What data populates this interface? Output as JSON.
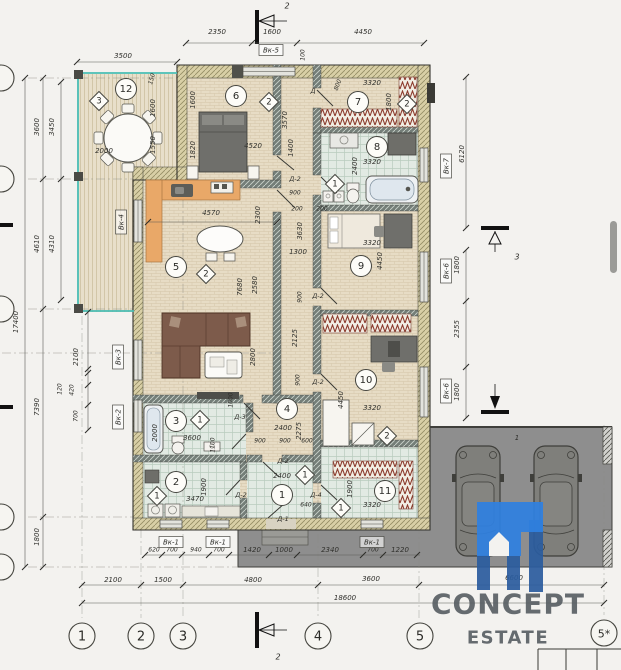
{
  "logo": {
    "line1": "CONCEPT",
    "line2": "ESTATE"
  },
  "colors": {
    "background": "#F3F2EF",
    "accent_teal": "#49BDB3",
    "wall_hatch": "#747E78",
    "wall_insulation": "#D8CFA6",
    "floor_wood": "#E7DCC5",
    "floor_tile": "#E2EAE3",
    "kitchen_counter": "#E9A868",
    "sofa_brown": "#7D5B4B",
    "radiator_red": "#8C3A2C",
    "garage_grey": "#8E8E8E",
    "logo_blue": "#2F80E0",
    "logo_blue_dark": "#2B5D9E",
    "logo_text": "#5A6065",
    "ink": "#30302C"
  },
  "grid_bubbles": [
    {
      "label": "1",
      "x": 82,
      "y": 636
    },
    {
      "label": "2",
      "x": 141,
      "y": 636
    },
    {
      "label": "3",
      "x": 183,
      "y": 636
    },
    {
      "label": "4",
      "x": 318,
      "y": 636
    },
    {
      "label": "5",
      "x": 420,
      "y": 636
    },
    {
      "label": "5*",
      "x": 604,
      "y": 633
    }
  ],
  "left_grid_bubbles": [
    {
      "y": 78
    },
    {
      "y": 179
    },
    {
      "y": 309
    },
    {
      "y": 517
    },
    {
      "y": 567
    }
  ],
  "rooms": [
    {
      "n": "12",
      "x": 126,
      "y": 89
    },
    {
      "n": "6",
      "x": 236,
      "y": 96
    },
    {
      "n": "7",
      "x": 358,
      "y": 102
    },
    {
      "n": "8",
      "x": 377,
      "y": 147
    },
    {
      "n": "5",
      "x": 176,
      "y": 267
    },
    {
      "n": "9",
      "x": 361,
      "y": 266
    },
    {
      "n": "10",
      "x": 366,
      "y": 380
    },
    {
      "n": "4",
      "x": 287,
      "y": 409
    },
    {
      "n": "3",
      "x": 176,
      "y": 421
    },
    {
      "n": "2",
      "x": 176,
      "y": 482
    },
    {
      "n": "1",
      "x": 282,
      "y": 495
    },
    {
      "n": "11",
      "x": 385,
      "y": 491
    }
  ],
  "diamonds": [
    {
      "n": "3",
      "x": 99,
      "y": 101
    },
    {
      "n": "2",
      "x": 269,
      "y": 102
    },
    {
      "n": "2",
      "x": 407,
      "y": 104
    },
    {
      "n": "1",
      "x": 335,
      "y": 184
    },
    {
      "n": "2",
      "x": 206,
      "y": 274
    },
    {
      "n": "1",
      "x": 305,
      "y": 475
    },
    {
      "n": "2",
      "x": 387,
      "y": 436
    },
    {
      "n": "1",
      "x": 200,
      "y": 420
    },
    {
      "n": "1",
      "x": 157,
      "y": 496
    },
    {
      "n": "1",
      "x": 341,
      "y": 508
    }
  ],
  "boxed_labels": [
    {
      "t": "Вк-5",
      "x": 271,
      "y": 50
    },
    {
      "t": "Вк-4",
      "x": 121,
      "y": 222,
      "rot": -90
    },
    {
      "t": "Вк-3",
      "x": 118,
      "y": 357,
      "rot": -90
    },
    {
      "t": "Вк-2",
      "x": 118,
      "y": 417,
      "rot": -90
    },
    {
      "t": "Вк-7",
      "x": 446,
      "y": 166,
      "rot": -90
    },
    {
      "t": "Вк-6",
      "x": 446,
      "y": 271,
      "rot": -90
    },
    {
      "t": "Вк-6",
      "x": 446,
      "y": 391,
      "rot": -90
    },
    {
      "t": "Вк-1",
      "x": 171,
      "y": 542
    },
    {
      "t": "Вк-1",
      "x": 218,
      "y": 542
    },
    {
      "t": "Вк-1",
      "x": 372,
      "y": 542
    }
  ],
  "annotations": [
    {
      "t": "3500",
      "x": 123,
      "y": 56
    },
    {
      "t": "2350",
      "x": 217,
      "y": 32
    },
    {
      "t": "1600",
      "x": 272,
      "y": 32
    },
    {
      "t": "4450",
      "x": 363,
      "y": 32
    },
    {
      "t": "100",
      "x": 303,
      "y": 55,
      "rot": -90,
      "fs": 6
    },
    {
      "t": "2",
      "x": 287,
      "y": 6,
      "fs": 8
    },
    {
      "t": "2",
      "x": 278,
      "y": 657,
      "fs": 8
    },
    {
      "t": "3",
      "x": 517,
      "y": 257,
      "fs": 8
    },
    {
      "t": "3600",
      "x": 37,
      "y": 127,
      "rot": -90
    },
    {
      "t": "3450",
      "x": 52,
      "y": 127,
      "rot": -90
    },
    {
      "t": "4610",
      "x": 37,
      "y": 244,
      "rot": -90
    },
    {
      "t": "4310",
      "x": 52,
      "y": 244,
      "rot": -90
    },
    {
      "t": "17400",
      "x": 16,
      "y": 322,
      "rot": -90
    },
    {
      "t": "7390",
      "x": 37,
      "y": 407,
      "rot": -90
    },
    {
      "t": "1800",
      "x": 37,
      "y": 537,
      "rot": -90
    },
    {
      "t": "2100",
      "x": 76,
      "y": 357,
      "rot": -90
    },
    {
      "t": "120",
      "x": 60,
      "y": 389,
      "rot": -90,
      "fs": 6
    },
    {
      "t": "420",
      "x": 72,
      "y": 390,
      "rot": -90,
      "fs": 6
    },
    {
      "t": "700",
      "x": 76,
      "y": 416,
      "rot": -90,
      "fs": 6
    },
    {
      "t": "150",
      "x": 152,
      "y": 79,
      "rot": -75,
      "fs": 6
    },
    {
      "t": "1600",
      "x": 153,
      "y": 108,
      "rot": -90
    },
    {
      "t": "1550",
      "x": 153,
      "y": 145,
      "rot": -90
    },
    {
      "t": "2000",
      "x": 104,
      "y": 151
    },
    {
      "t": "1600",
      "x": 193,
      "y": 100,
      "rot": -90
    },
    {
      "t": "1820",
      "x": 193,
      "y": 150,
      "rot": -90
    },
    {
      "t": "4520",
      "x": 253,
      "y": 146
    },
    {
      "t": "3570",
      "x": 285,
      "y": 120,
      "rot": -90
    },
    {
      "t": "1400",
      "x": 291,
      "y": 148,
      "rot": -90
    },
    {
      "t": "900",
      "x": 295,
      "y": 193,
      "fs": 6
    },
    {
      "t": "200",
      "x": 297,
      "y": 209,
      "fs": 6
    },
    {
      "t": "Д-2",
      "x": 295,
      "y": 179,
      "fs": 6.5
    },
    {
      "t": "3320",
      "x": 372,
      "y": 83
    },
    {
      "t": "800",
      "x": 338,
      "y": 85,
      "rot": -70,
      "fs": 6
    },
    {
      "t": "Д",
      "x": 313,
      "y": 91,
      "fs": 6.5
    },
    {
      "t": "1800",
      "x": 389,
      "y": 102,
      "rot": -90
    },
    {
      "t": "3320",
      "x": 372,
      "y": 162
    },
    {
      "t": "2400",
      "x": 355,
      "y": 166,
      "rot": -90
    },
    {
      "t": "200",
      "x": 322,
      "y": 209,
      "fs": 6
    },
    {
      "t": "3320",
      "x": 372,
      "y": 243
    },
    {
      "t": "4450",
      "x": 380,
      "y": 261,
      "rot": -90
    },
    {
      "t": "4570",
      "x": 211,
      "y": 213
    },
    {
      "t": "2300",
      "x": 258,
      "y": 215,
      "rot": -90
    },
    {
      "t": "3630",
      "x": 300,
      "y": 231,
      "rot": -90
    },
    {
      "t": "1300",
      "x": 298,
      "y": 252
    },
    {
      "t": "7680",
      "x": 240,
      "y": 287,
      "rot": -90
    },
    {
      "t": "2580",
      "x": 255,
      "y": 285,
      "rot": -90
    },
    {
      "t": "900",
      "x": 300,
      "y": 297,
      "rot": -90,
      "fs": 6
    },
    {
      "t": "2800",
      "x": 253,
      "y": 357,
      "rot": -90
    },
    {
      "t": "2125",
      "x": 295,
      "y": 338,
      "rot": -90
    },
    {
      "t": "900",
      "x": 298,
      "y": 380,
      "rot": -90,
      "fs": 6
    },
    {
      "t": "1000",
      "x": 231,
      "y": 400,
      "rot": -90,
      "fs": 6
    },
    {
      "t": "6120",
      "x": 462,
      "y": 154,
      "rot": -90
    },
    {
      "t": "1800",
      "x": 457,
      "y": 265,
      "rot": -90
    },
    {
      "t": "2355",
      "x": 457,
      "y": 329,
      "rot": -90
    },
    {
      "t": "1800",
      "x": 457,
      "y": 392,
      "rot": -90
    },
    {
      "t": "3320",
      "x": 372,
      "y": 408
    },
    {
      "t": "4450",
      "x": 341,
      "y": 400,
      "rot": -90
    },
    {
      "t": "Д-2",
      "x": 318,
      "y": 296,
      "fs": 6.5
    },
    {
      "t": "Д-2",
      "x": 318,
      "y": 382,
      "fs": 6.5
    },
    {
      "t": "2400",
      "x": 283,
      "y": 428
    },
    {
      "t": "2275",
      "x": 299,
      "y": 431,
      "rot": -90
    },
    {
      "t": "900",
      "x": 260,
      "y": 441,
      "fs": 6
    },
    {
      "t": "900",
      "x": 285,
      "y": 441,
      "fs": 6
    },
    {
      "t": "600",
      "x": 307,
      "y": 441,
      "fs": 6
    },
    {
      "t": "Д-3",
      "x": 240,
      "y": 417,
      "fs": 6.5
    },
    {
      "t": "3600",
      "x": 192,
      "y": 438
    },
    {
      "t": "2000",
      "x": 155,
      "y": 433,
      "rot": -90
    },
    {
      "t": "1100",
      "x": 213,
      "y": 445,
      "rot": -90,
      "fs": 6
    },
    {
      "t": "3470",
      "x": 195,
      "y": 499
    },
    {
      "t": "1900",
      "x": 204,
      "y": 487,
      "rot": -90
    },
    {
      "t": "Д-2",
      "x": 241,
      "y": 495,
      "fs": 6.5
    },
    {
      "t": "Д-2",
      "x": 283,
      "y": 461,
      "fs": 6.5
    },
    {
      "t": "2400",
      "x": 282,
      "y": 476
    },
    {
      "t": "640",
      "x": 306,
      "y": 505,
      "fs": 6
    },
    {
      "t": "Д-4",
      "x": 316,
      "y": 495,
      "fs": 6.5
    },
    {
      "t": "Д-1",
      "x": 283,
      "y": 519,
      "fs": 6.5
    },
    {
      "t": "1900",
      "x": 350,
      "y": 489,
      "rot": -90
    },
    {
      "t": "3320",
      "x": 372,
      "y": 505
    },
    {
      "t": "1",
      "x": 517,
      "y": 438,
      "fs": 7
    },
    {
      "t": "620",
      "x": 154,
      "y": 550,
      "fs": 6
    },
    {
      "t": "700",
      "x": 172,
      "y": 550,
      "fs": 6
    },
    {
      "t": "940",
      "x": 196,
      "y": 550,
      "fs": 6
    },
    {
      "t": "700",
      "x": 219,
      "y": 550,
      "fs": 6
    },
    {
      "t": "1420",
      "x": 252,
      "y": 550
    },
    {
      "t": "1000",
      "x": 284,
      "y": 550
    },
    {
      "t": "2340",
      "x": 330,
      "y": 550
    },
    {
      "t": "700",
      "x": 373,
      "y": 550,
      "fs": 6
    },
    {
      "t": "1220",
      "x": 400,
      "y": 550
    },
    {
      "t": "2100",
      "x": 113,
      "y": 580
    },
    {
      "t": "1500",
      "x": 163,
      "y": 580
    },
    {
      "t": "4800",
      "x": 253,
      "y": 580
    },
    {
      "t": "3600",
      "x": 371,
      "y": 579
    },
    {
      "t": "6600",
      "x": 514,
      "y": 578
    },
    {
      "t": "18600",
      "x": 345,
      "y": 598
    }
  ],
  "dim_lines": [
    {
      "x1": 77,
      "y1": 62,
      "x2": 177,
      "y2": 62,
      "ticks": [
        [
          77,
          62
        ],
        [
          177,
          62
        ]
      ]
    },
    {
      "x1": 186,
      "y1": 43,
      "x2": 424,
      "y2": 43,
      "ticks": [
        [
          186,
          43
        ],
        [
          252,
          43
        ],
        [
          297,
          43
        ],
        [
          424,
          43
        ]
      ]
    },
    {
      "x1": 25,
      "y1": 78,
      "x2": 25,
      "y2": 567,
      "ticks": [
        [
          25,
          78
        ],
        [
          25,
          567
        ]
      ]
    },
    {
      "x1": 43,
      "y1": 78,
      "x2": 43,
      "y2": 567,
      "ticks": [
        [
          43,
          78
        ],
        [
          43,
          179
        ],
        [
          43,
          309
        ],
        [
          43,
          517
        ],
        [
          43,
          567
        ]
      ]
    },
    {
      "x1": 61,
      "y1": 82,
      "x2": 61,
      "y2": 300,
      "ticks": [
        [
          61,
          82
        ],
        [
          61,
          179
        ],
        [
          61,
          300
        ]
      ]
    },
    {
      "x1": 88,
      "y1": 312,
      "x2": 88,
      "y2": 430,
      "ticks": [
        [
          88,
          312
        ],
        [
          88,
          369
        ],
        [
          88,
          373
        ],
        [
          88,
          385
        ],
        [
          88,
          405
        ],
        [
          88,
          430
        ]
      ]
    },
    {
      "x1": 466,
      "y1": 77,
      "x2": 466,
      "y2": 228,
      "ticks": [
        [
          466,
          77
        ],
        [
          466,
          228
        ]
      ]
    },
    {
      "x1": 466,
      "y1": 250,
      "x2": 466,
      "y2": 418,
      "ticks": [
        [
          466,
          250
        ],
        [
          466,
          301
        ],
        [
          466,
          367
        ],
        [
          466,
          418
        ]
      ]
    },
    {
      "x1": 145,
      "y1": 555,
      "x2": 420,
      "y2": 555,
      "ticks": [
        [
          145,
          555
        ],
        [
          162,
          555
        ],
        [
          182,
          555
        ],
        [
          209,
          555
        ],
        [
          229,
          555
        ],
        [
          269,
          555
        ],
        [
          297,
          555
        ],
        [
          363,
          555
        ],
        [
          383,
          555
        ],
        [
          417,
          555
        ]
      ]
    },
    {
      "x1": 82,
      "y1": 585,
      "x2": 604,
      "y2": 585,
      "ticks": [
        [
          82,
          585
        ],
        [
          141,
          585
        ],
        [
          183,
          585
        ],
        [
          318,
          585
        ],
        [
          419,
          585
        ],
        [
          604,
          585
        ]
      ]
    },
    {
      "x1": 82,
      "y1": 603,
      "x2": 604,
      "y2": 603,
      "ticks": [
        [
          82,
          603
        ],
        [
          604,
          603
        ]
      ]
    },
    {
      "x1": 148,
      "y1": 222,
      "x2": 277,
      "y2": 222,
      "ticks": [
        [
          148,
          222
        ],
        [
          277,
          222
        ]
      ]
    }
  ]
}
